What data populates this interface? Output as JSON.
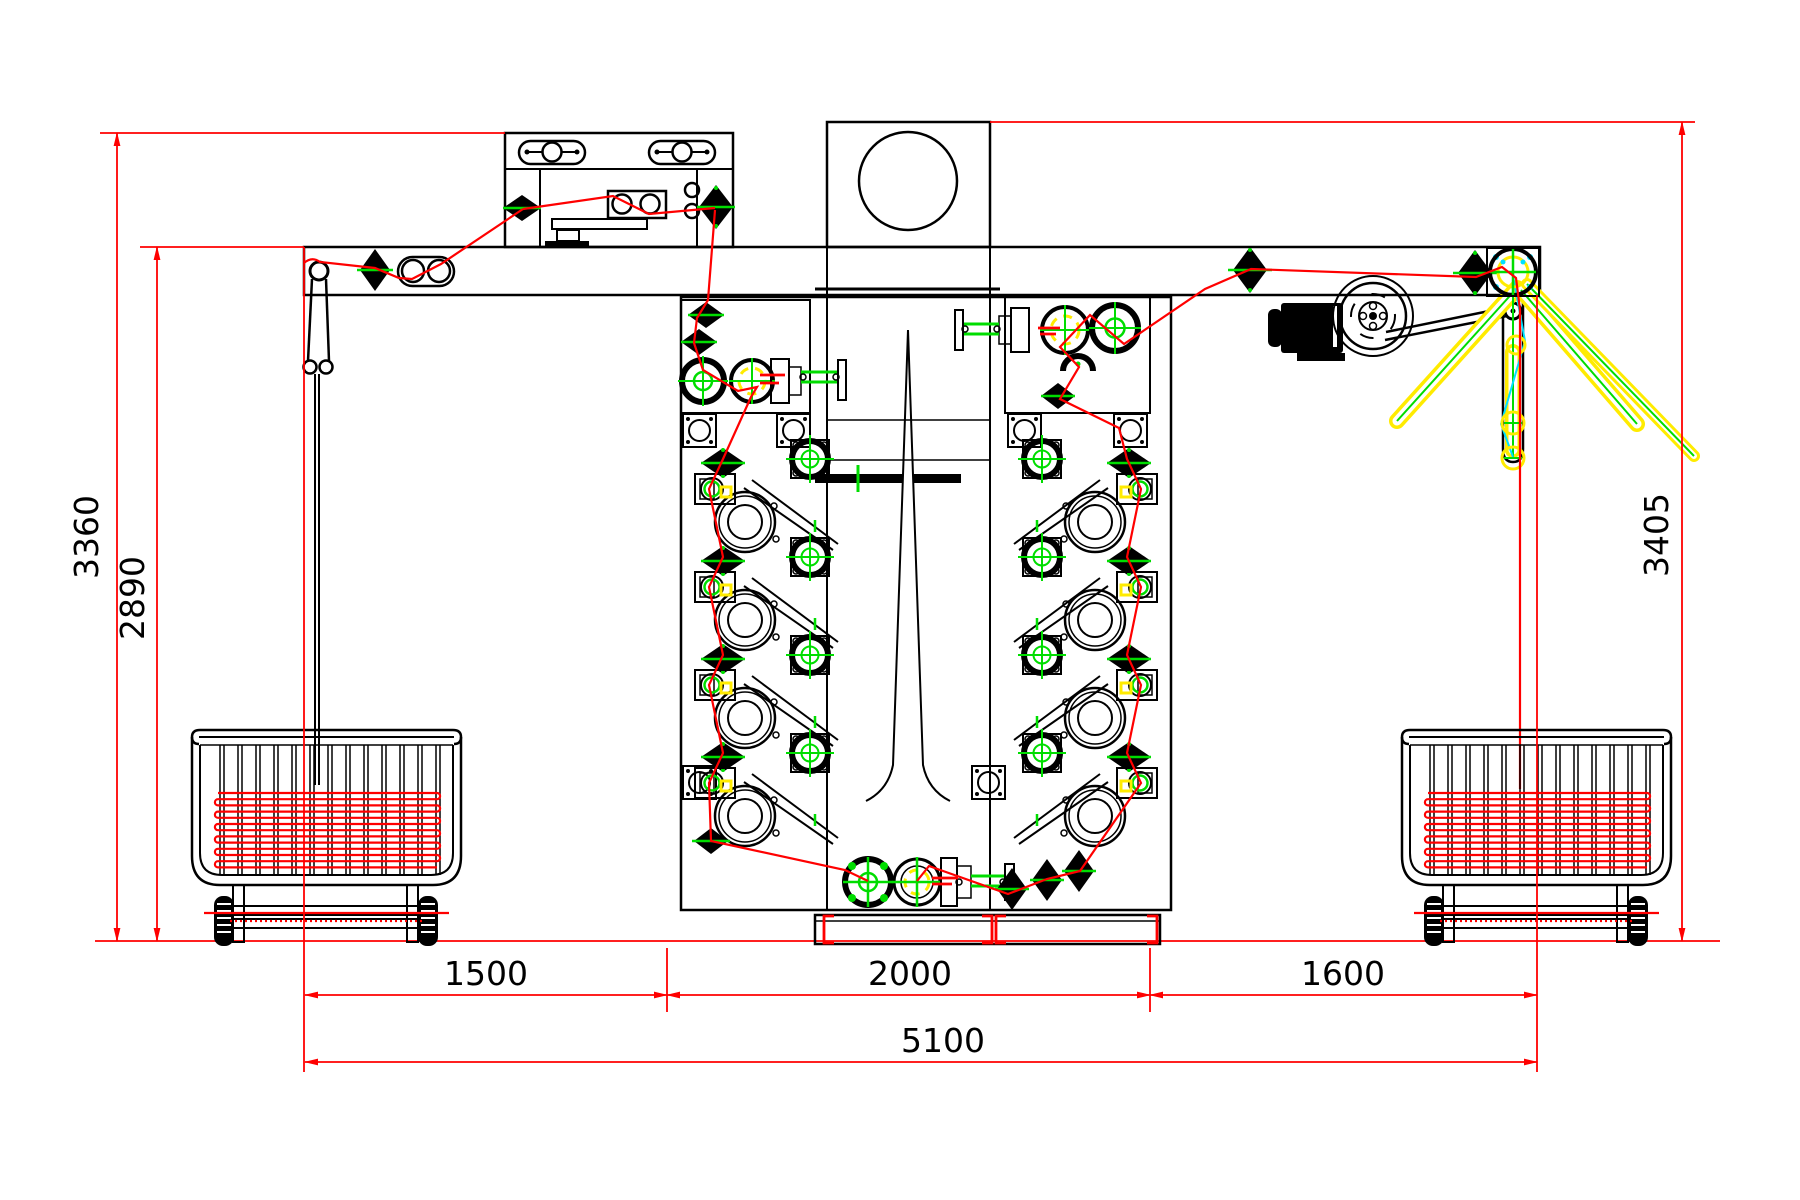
{
  "drawing": {
    "title": "Rope washing machine - front elevation with rope carts",
    "type": "CAD 2D engineering drawing",
    "dimensions_mm": {
      "height_outer_left": "3360",
      "height_inner_left": "2890",
      "height_right": "3405",
      "span_left": "1500",
      "span_center": "2000",
      "span_right": "1600",
      "span_total": "5100"
    },
    "colors": {
      "outline": "#000000",
      "dimension": "#ff0000",
      "rope": "#ff0000",
      "accent_green": "#00dd00",
      "accent_yellow": "#ffeb00",
      "accent_cyan": "#00e0ff",
      "background": "#ffffff"
    }
  }
}
